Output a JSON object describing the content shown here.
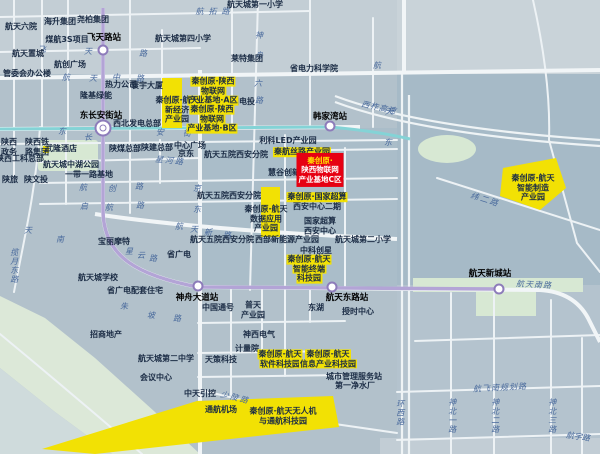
{
  "map": {
    "colors": {
      "background": "#b2c1cb",
      "top_band": "#c3ced5",
      "dense_block": "#a6bac7",
      "road_white": "#eef3f5",
      "park_green": "#d7e8d3",
      "slope_green": "#dce8d8",
      "highlight_yellow": "#f2e104",
      "highlight_red": "#e60012",
      "metro_purple": "#b3a4d6",
      "metro_teal": "#84d3d6",
      "street_text_blue": "#48699c",
      "poi_text_navy": "#1b2c45"
    },
    "stations": [
      {
        "name": "飞天路站",
        "x": 103,
        "y": 50,
        "lx": 104,
        "ly": 38,
        "interchange": false
      },
      {
        "name": "东长安街站",
        "x": 103,
        "y": 128,
        "lx": 101,
        "ly": 116,
        "interchange": true
      },
      {
        "name": "韩家湾站",
        "x": 330,
        "y": 126,
        "lx": 330,
        "ly": 117,
        "interchange": false
      },
      {
        "name": "神舟大道站",
        "x": 198,
        "y": 286,
        "lx": 197,
        "ly": 298,
        "interchange": false
      },
      {
        "name": "航天东路站",
        "x": 332,
        "y": 287,
        "lx": 347,
        "ly": 298,
        "interchange": false
      },
      {
        "name": "航天新城站",
        "x": 499,
        "y": 289,
        "lx": 490,
        "ly": 274,
        "interchange": false
      }
    ],
    "streets": [
      {
        "t": "航拓路",
        "x": 215,
        "y": 12,
        "ls": 5
      },
      {
        "t": "飞",
        "x": 42,
        "y": 50
      },
      {
        "t": "天",
        "x": 88,
        "y": 52
      },
      {
        "t": "路",
        "x": 143,
        "y": 54
      },
      {
        "t": "航",
        "x": 66,
        "y": 78
      },
      {
        "t": "天",
        "x": 93,
        "y": 79
      },
      {
        "t": "中",
        "x": 116,
        "y": 78
      },
      {
        "t": "路",
        "x": 140,
        "y": 79
      },
      {
        "t": "东",
        "x": 62,
        "y": 132
      },
      {
        "t": "长",
        "x": 88,
        "y": 138
      },
      {
        "t": "安",
        "x": 160,
        "y": 133
      },
      {
        "t": "街",
        "x": 187,
        "y": 134
      },
      {
        "t": "神",
        "x": 259,
        "y": 36
      },
      {
        "t": "舟",
        "x": 259,
        "y": 56
      },
      {
        "t": "六",
        "x": 258,
        "y": 84
      },
      {
        "t": "路",
        "x": 259,
        "y": 101
      },
      {
        "t": "航",
        "x": 377,
        "y": 66
      },
      {
        "t": "天",
        "x": 389,
        "y": 112
      },
      {
        "t": "东",
        "x": 388,
        "y": 143
      },
      {
        "t": "星河路",
        "x": 170,
        "y": 161,
        "r": 6,
        "ls": 2
      },
      {
        "t": "京",
        "x": 197,
        "y": 189
      },
      {
        "t": "东",
        "x": 197,
        "y": 210
      },
      {
        "t": "航",
        "x": 83,
        "y": 188
      },
      {
        "t": "创",
        "x": 112,
        "y": 189
      },
      {
        "t": "路",
        "x": 139,
        "y": 187
      },
      {
        "t": "启",
        "x": 84,
        "y": 207
      },
      {
        "t": "航",
        "x": 109,
        "y": 208
      },
      {
        "t": "路",
        "x": 140,
        "y": 206
      },
      {
        "t": "航",
        "x": 179,
        "y": 227
      },
      {
        "t": "天",
        "x": 194,
        "y": 230
      },
      {
        "t": "新",
        "x": 208,
        "y": 233
      },
      {
        "t": "路",
        "x": 227,
        "y": 236
      },
      {
        "t": "天",
        "x": 28,
        "y": 231
      },
      {
        "t": "南",
        "x": 60,
        "y": 240
      },
      {
        "t": "星",
        "x": 129,
        "y": 252
      },
      {
        "t": "云",
        "x": 141,
        "y": 256
      },
      {
        "t": "路",
        "x": 153,
        "y": 259
      },
      {
        "t": "揽月东路",
        "x": 14,
        "y": 266,
        "v": true
      },
      {
        "t": "朱",
        "x": 124,
        "y": 307
      },
      {
        "t": "坡",
        "x": 151,
        "y": 316
      },
      {
        "t": "路",
        "x": 177,
        "y": 319
      },
      {
        "t": "少陵路",
        "x": 235,
        "y": 398,
        "r": 14,
        "ls": 2
      },
      {
        "t": "西柞高速",
        "x": 379,
        "y": 108,
        "r": 12,
        "ls": 1
      },
      {
        "t": "纬二路",
        "x": 485,
        "y": 200,
        "r": 17,
        "ls": 2
      },
      {
        "t": "航天南路",
        "x": 534,
        "y": 285,
        "r": 3,
        "ls": 1
      },
      {
        "t": "航飞南规划路",
        "x": 500,
        "y": 388,
        "r": -3,
        "ls": 1
      },
      {
        "t": "神北一路",
        "x": 452,
        "y": 416,
        "v": true
      },
      {
        "t": "神北二路",
        "x": 495,
        "y": 416,
        "v": true
      },
      {
        "t": "神北三路",
        "x": 552,
        "y": 416,
        "v": true
      },
      {
        "t": "环西路",
        "x": 400,
        "y": 413,
        "v": true
      },
      {
        "t": "航宇路",
        "x": 578,
        "y": 437,
        "r": 8
      }
    ],
    "pois": [
      {
        "t": "航天六院",
        "x": 21,
        "y": 27
      },
      {
        "t": "海升集团",
        "x": 60,
        "y": 22
      },
      {
        "t": "尧柏集团",
        "x": 93,
        "y": 20
      },
      {
        "t": "煤航3S项目",
        "x": 67,
        "y": 40
      },
      {
        "t": "航天置城",
        "x": 28,
        "y": 54
      },
      {
        "t": "航创广场",
        "x": 70,
        "y": 65
      },
      {
        "t": "管委会办公楼",
        "x": 27,
        "y": 74
      },
      {
        "t": "热力公司",
        "x": 121,
        "y": 85
      },
      {
        "t": "寰宇大厦",
        "x": 147,
        "y": 86
      },
      {
        "t": "隆基绿能",
        "x": 96,
        "y": 96
      },
      {
        "t": "西北发电总部",
        "x": 137,
        "y": 124
      },
      {
        "t": "航天城第四小学",
        "x": 183,
        "y": 39
      },
      {
        "t": "航天城第一小学",
        "x": 255,
        "y": 5
      },
      {
        "t": "莱特集团",
        "x": 247,
        "y": 59
      },
      {
        "t": "省电力科学院",
        "x": 314,
        "y": 69
      },
      {
        "t": "国电投",
        "x": 243,
        "y": 102
      },
      {
        "t": "利科LED产业园",
        "x": 288,
        "y": 141
      },
      {
        "t": "慧谷创新园",
        "x": 288,
        "y": 173
      },
      {
        "t": "航天五院西安分院",
        "x": 236,
        "y": 155
      },
      {
        "t": "航天五院西安分院",
        "x": 229,
        "y": 196
      },
      {
        "t": "航天五院西安分院",
        "x": 222,
        "y": 240
      },
      {
        "t": "西部新能源产业园",
        "x": 287,
        "y": 240
      },
      {
        "t": "航天城第二小学",
        "x": 363,
        "y": 240
      },
      {
        "t": "中科创星",
        "x": 316,
        "y": 251
      },
      {
        "lines": [
          "国家超算",
          "西安中心"
        ],
        "x": 320,
        "y": 226
      },
      {
        "t": "西安中心二期",
        "x": 317,
        "y": 207
      },
      {
        "lines": [
          "陕西",
          "政务"
        ],
        "x": 9,
        "y": 147
      },
      {
        "lines": [
          "陕西铁",
          "路集团"
        ],
        "x": 37,
        "y": 147
      },
      {
        "t": "陕西工科总部",
        "x": 20,
        "y": 159
      },
      {
        "t": "陕旅",
        "x": 10,
        "y": 180
      },
      {
        "t": "陕文投",
        "x": 36,
        "y": 180
      },
      {
        "t": "武隆酒店",
        "x": 61,
        "y": 149
      },
      {
        "t": "航天城中湖公园",
        "x": 71,
        "y": 165
      },
      {
        "t": "陕煤总部",
        "x": 125,
        "y": 149
      },
      {
        "t": "陕建总部",
        "x": 157,
        "y": 148
      },
      {
        "t": "中心广场",
        "x": 190,
        "y": 146
      },
      {
        "t": "京东",
        "x": 186,
        "y": 154
      },
      {
        "t": "一带一路基地",
        "x": 89,
        "y": 175
      },
      {
        "t": "宝丽摩特",
        "x": 114,
        "y": 242
      },
      {
        "t": "省广电",
        "x": 179,
        "y": 255
      },
      {
        "t": "航天城学校",
        "x": 98,
        "y": 278
      },
      {
        "t": "省广电配套住宅",
        "x": 135,
        "y": 291
      },
      {
        "t": "招商地产",
        "x": 106,
        "y": 335
      },
      {
        "t": "航天城第二中学",
        "x": 166,
        "y": 359
      },
      {
        "t": "会议中心",
        "x": 156,
        "y": 378
      },
      {
        "t": "中国通号",
        "x": 218,
        "y": 308
      },
      {
        "lines": [
          "普天",
          "产业园"
        ],
        "x": 253,
        "y": 310
      },
      {
        "t": "东湖",
        "x": 316,
        "y": 308
      },
      {
        "t": "授时中心",
        "x": 358,
        "y": 312
      },
      {
        "t": "神西电气",
        "x": 259,
        "y": 335
      },
      {
        "t": "计量院",
        "x": 247,
        "y": 349
      },
      {
        "t": "天策科技",
        "x": 221,
        "y": 360
      },
      {
        "t": "中天引控",
        "x": 200,
        "y": 394
      },
      {
        "t": "城市管理服务站",
        "x": 354,
        "y": 377
      },
      {
        "t": "第一净水厂",
        "x": 355,
        "y": 386
      },
      {
        "t": "通航机场",
        "x": 221,
        "y": 410
      }
    ],
    "yellow_labels": [
      {
        "lines": [
          "秦创原·陕西",
          "物联网",
          "产业基地·A区"
        ],
        "x": 213,
        "y": 91
      },
      {
        "lines": [
          "秦创原·陕西",
          "物联网",
          "产业基地·B区"
        ],
        "x": 212,
        "y": 119
      },
      {
        "lines": [
          "秦创原·航天",
          "新经济",
          "产业园"
        ],
        "x": 177,
        "y": 110,
        "noband": true
      },
      {
        "lines": [
          "秦创原·航天",
          "数据应用",
          "产业园"
        ],
        "x": 266,
        "y": 219,
        "noband": true
      },
      {
        "lines": [
          "秦航丝路产业园"
        ],
        "x": 302,
        "y": 152
      },
      {
        "lines": [
          "秦创原·国家超算"
        ],
        "x": 317,
        "y": 197
      },
      {
        "lines": [
          "秦创原·航天",
          "智能终端",
          "科技园"
        ],
        "x": 309,
        "y": 269
      },
      {
        "lines": [
          "秦创原·航天",
          "软件科技园"
        ],
        "x": 280,
        "y": 359
      },
      {
        "lines": [
          "秦创原·航天",
          "信息产业科技园"
        ],
        "x": 328,
        "y": 359
      },
      {
        "lines": [
          "秦创原·航天",
          "智能制造",
          "产业园"
        ],
        "x": 533,
        "y": 188,
        "noband": true
      },
      {
        "lines": [
          "秦创原·航天无人机",
          "与通航科技园"
        ],
        "x": 283,
        "y": 416,
        "noband": true
      }
    ],
    "red_label": {
      "lines": [
        "秦创原·",
        "陕西物联网",
        "产业基地C区"
      ],
      "x": 320,
      "y": 170
    }
  }
}
